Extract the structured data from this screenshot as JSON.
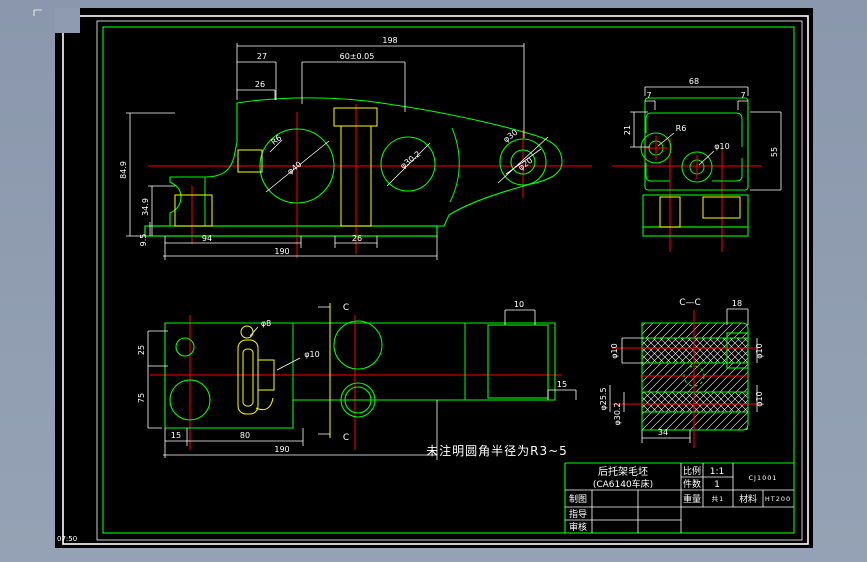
{
  "colors": {
    "bg": "#8e9bb0",
    "canvas": "#000000",
    "green": "#00ff00",
    "red": "#ff0000",
    "yellow": "#ffff00",
    "white": "#ffffff"
  },
  "status_text": "07:50",
  "note": "未注明圆角半径为R3~5",
  "sections": {
    "flag_top": "C",
    "flag_bottom": "C",
    "title": "C—C"
  },
  "titleblock": {
    "name1": "后托架毛坯",
    "name2": "(CA6140车床)",
    "scale_label": "比例",
    "scale_value": "1:1",
    "qty_label": "件数",
    "qty_value": "1",
    "weight_label": "重量",
    "weight_value": "共1",
    "material_label": "材料",
    "material_value": "HT200",
    "drawing_no": "CJ1001",
    "row1": "制图",
    "row2": "指导",
    "row3": "审核"
  },
  "dims": {
    "f_total": "198",
    "f_27": "27",
    "f_60": "60±0.05",
    "f_26": "26",
    "f_r6": "R6",
    "f_d40": "φ40",
    "f_d302": "φ30.2",
    "f_d30": "φ30",
    "f_d20": "φ20",
    "f_849": "84.9",
    "f_349": "34.9",
    "f_95": "9.5",
    "f_94": "94",
    "f_26b": "26",
    "f_190": "190",
    "s_68": "68",
    "s_7l": "7",
    "s_7r": "7",
    "s_21": "21",
    "s_55": "55",
    "s_r6": "R6",
    "s_d10": "φ10",
    "p_d8": "φ8",
    "p_d10": "φ10",
    "p_15": "15",
    "p_80": "80",
    "p_190": "190",
    "p_10": "10",
    "p_15r": "15",
    "p_25": "25",
    "p_75": "75",
    "c_18": "18",
    "c_d10l": "φ10",
    "c_d255": "φ25.5",
    "c_d302": "φ30.2",
    "c_d10r1": "φ10",
    "c_d10r2": "φ10",
    "c_34": "34"
  }
}
